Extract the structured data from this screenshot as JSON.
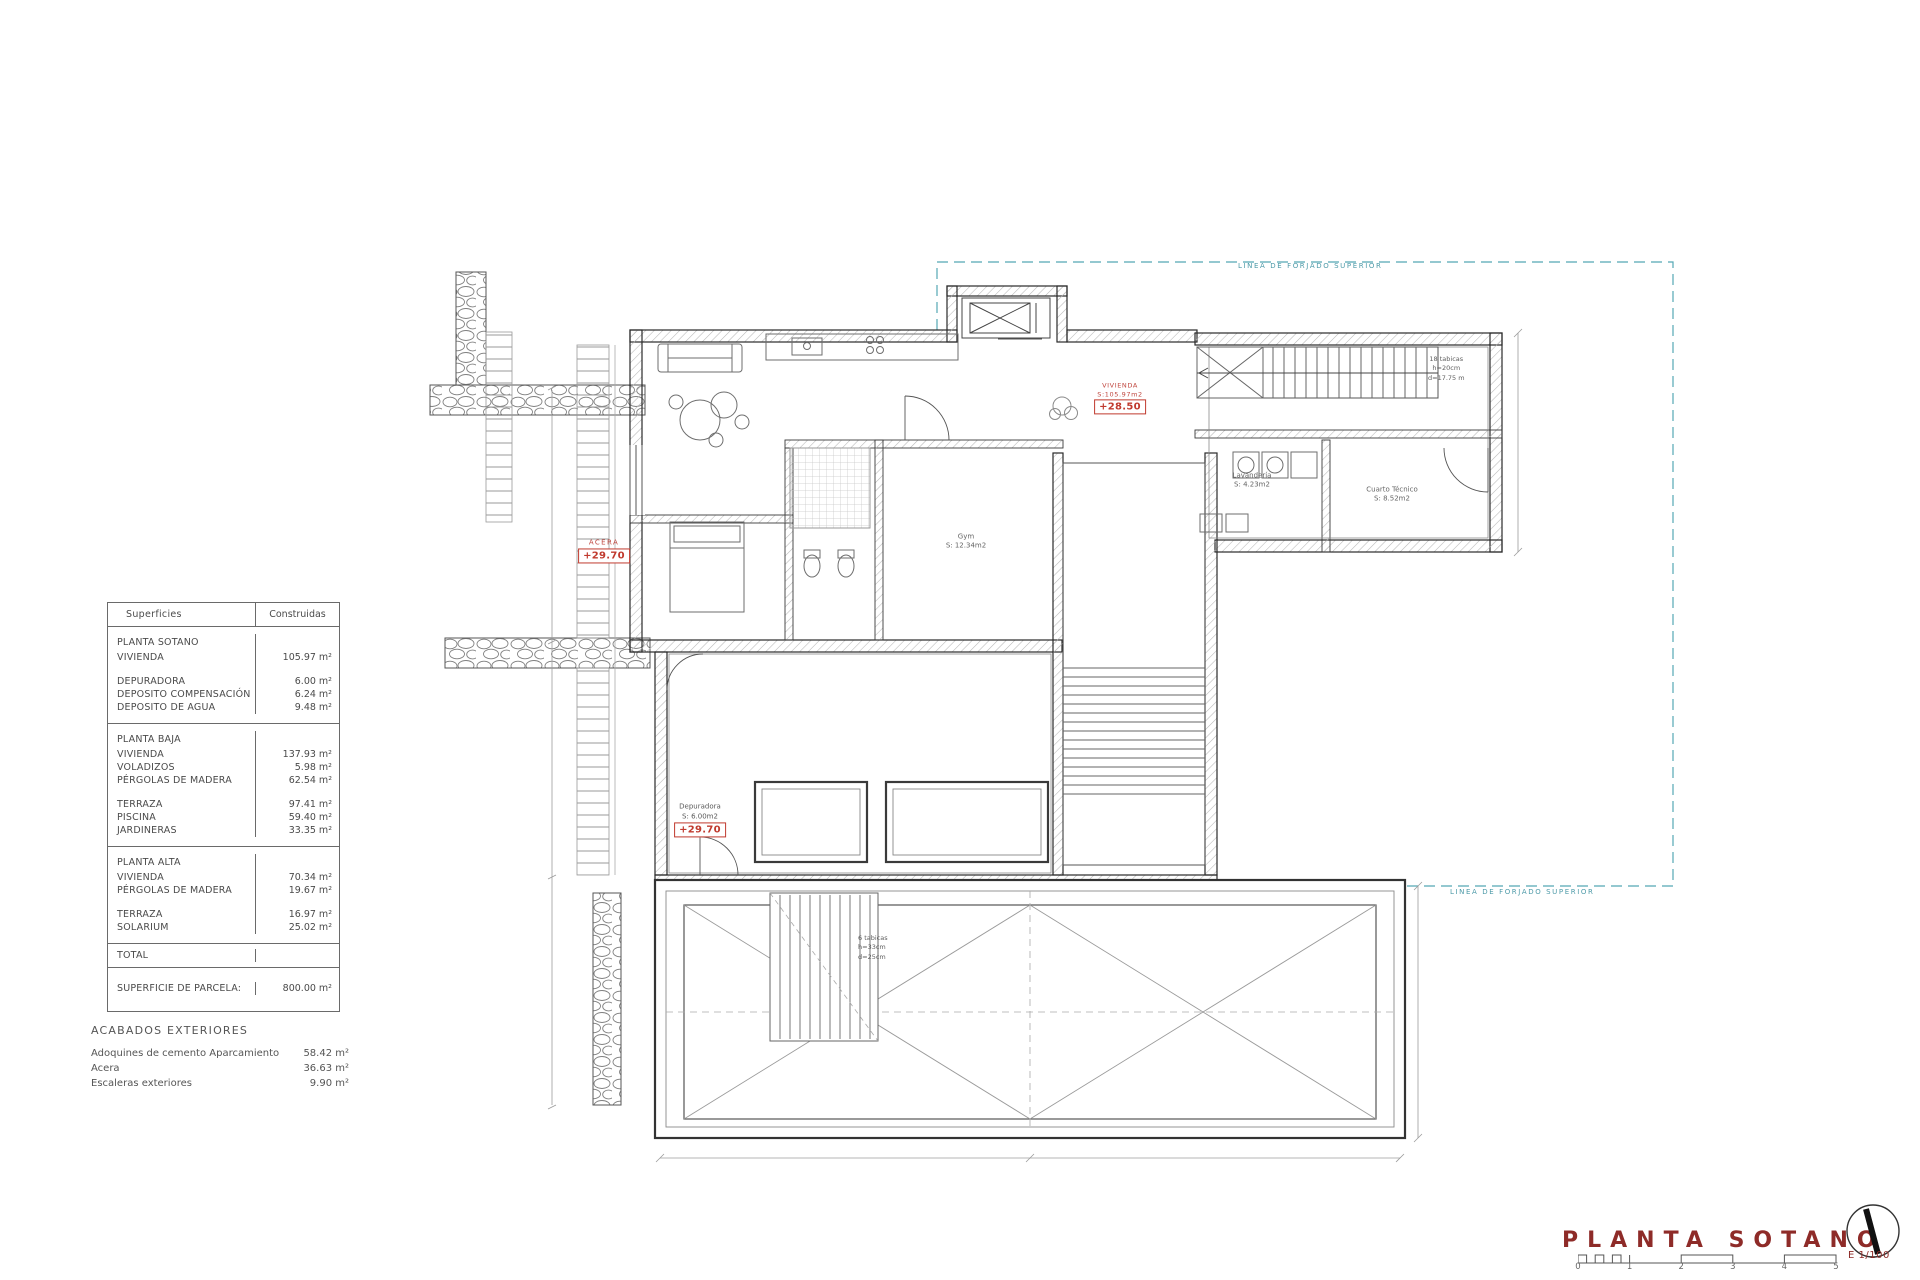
{
  "drawing": {
    "title": "PLANTA SOTANO",
    "scale_label": "E 1/100",
    "scale_ticks": [
      "0",
      "1",
      "2",
      "3",
      "4",
      "5"
    ]
  },
  "areas_table": {
    "col_surface": "Superficies",
    "col_built": "Construidas",
    "sections": [
      {
        "name": "PLANTA SOTANO",
        "rows": [
          {
            "label": "VIVIENDA",
            "value": "105.97 m²",
            "gap_after": true
          },
          {
            "label": "DEPURADORA",
            "value": "6.00 m²"
          },
          {
            "label": "DEPOSITO COMPENSACIÓN",
            "value": "6.24 m²"
          },
          {
            "label": "DEPOSITO DE AGUA",
            "value": "9.48 m²"
          }
        ]
      },
      {
        "name": "PLANTA BAJA",
        "rows": [
          {
            "label": "VIVIENDA",
            "value": "137.93 m²"
          },
          {
            "label": "VOLADIZOS",
            "value": "5.98 m²"
          },
          {
            "label": "PÉRGOLAS DE MADERA",
            "value": "62.54 m²",
            "gap_after": true
          },
          {
            "label": "TERRAZA",
            "value": "97.41 m²"
          },
          {
            "label": "PISCINA",
            "value": "59.40 m²"
          },
          {
            "label": "JARDINERAS",
            "value": "33.35 m²"
          }
        ]
      },
      {
        "name": "PLANTA ALTA",
        "rows": [
          {
            "label": "VIVIENDA",
            "value": "70.34 m²"
          },
          {
            "label": "PÉRGOLAS DE MADERA",
            "value": "19.67 m²",
            "gap_after": true
          },
          {
            "label": "TERRAZA",
            "value": "16.97 m²"
          },
          {
            "label": "SOLARIUM",
            "value": "25.02 m²"
          }
        ]
      }
    ],
    "total_label": "TOTAL",
    "parcel": {
      "label": "SUPERFICIE DE PARCELA:",
      "value": "800.00 m²"
    }
  },
  "exterior_finishes": {
    "heading": "ACABADOS EXTERIORES",
    "items": [
      {
        "label": "Adoquines de cemento Aparcamiento",
        "value": "58.42 m²"
      },
      {
        "label": "Acera",
        "value": "36.63 m²"
      },
      {
        "label": "Escaleras exteriores",
        "value": "9.90 m²"
      }
    ]
  },
  "plan_labels": {
    "forjado_top": "LINEA DE FORJADO SUPERIOR",
    "forjado_bottom": "LINEA DE FORJADO SUPERIOR",
    "acera": {
      "name": "ACERA",
      "level": "+29.70"
    },
    "vivienda": {
      "name": "VIVIENDA",
      "area": "S:105.97m2",
      "level": "+28.50"
    },
    "depuradora": {
      "name": "Depuradora",
      "area": "S: 6.00m2",
      "level": "+29.70"
    },
    "gym": {
      "name": "Gym",
      "area": "S: 12.34m2"
    },
    "lavanderia": {
      "name": "Lavandería",
      "area": "S: 4.23m2"
    },
    "cuarto_tecnico": {
      "name": "Cuarto Técnico",
      "area": "S: 8.52m2"
    },
    "stair_note_interior": "18 tabicas\nh=20cm\nd=17.75 m",
    "stair_note_exterior": "6 tabicas\nh=33cm\nd=25cm"
  },
  "colors": {
    "accent_red": "#c03a2e",
    "title_maroon": "#8e2b28",
    "forjado_teal": "#55a8b5"
  }
}
